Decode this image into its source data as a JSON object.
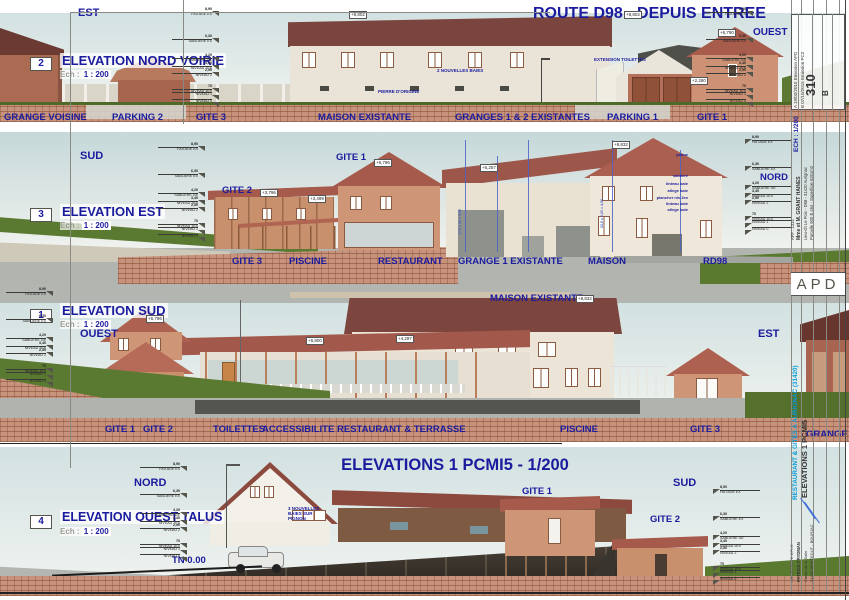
{
  "colors": {
    "label_navy": "#1b1b9e",
    "project_cyan": "#0a9bd8",
    "roof_red": "#8c4a3e",
    "timber": "#cf9577",
    "grass_green": "#5b7a31",
    "earth_brick": "#c8937c"
  },
  "sheet": {
    "route_title": "ROUTE D98 - DEPUIS ENTREE",
    "main_title": "ELEVATIONS 1 PCMI5  -  1/200"
  },
  "levels": {
    "items": [
      {
        "value": "8,90",
        "label": "FAITAGE EX",
        "gap": 0
      },
      {
        "value": "6,30",
        "label": "SABLIERE EX",
        "gap": 20
      },
      {
        "value": "4,20",
        "label": "SABLIERE GE",
        "gap": 12
      },
      {
        "value": "3,40",
        "label": "NIVEAU 2EX",
        "gap": 1
      },
      {
        "value": "2,50",
        "label": "NIVEAU 2",
        "gap": 0
      },
      {
        "value": "70",
        "label": "NIVEAU 1EX",
        "gap": 9
      },
      {
        "value": "",
        "label": "NIVEAU 1",
        "gap": 0
      },
      {
        "value": "",
        "label": "NIVEAU 0",
        "gap": 0
      }
    ]
  },
  "band1": {
    "number": "2",
    "title": "ELEVATION NORD VOIRIE",
    "ech": "Ech :",
    "scale": "1 : 200",
    "dir_left": "EST",
    "dir_right": "OUEST",
    "ann_baies": "2 NOUVELLES BAIES",
    "ann_pierre": "PIERRE D'ORIGINE",
    "ann_toilettes": "EXTENSION TOILETTES",
    "spot1": "+8,802",
    "spot2": "+8,802",
    "spot3": "+6,790",
    "spot4": "+2,280",
    "lbl_grange": "GRANGE VOISINE",
    "lbl_parking2": "PARKING 2",
    "lbl_gite3": "GITE 3",
    "lbl_maison": "MAISON EXISTANTE",
    "lbl_granges": "GRANGES 1 & 2 EXISTANTES",
    "lbl_parking1": "PARKING 1",
    "lbl_gite1": "GITE 1"
  },
  "band2": {
    "number": "3",
    "title": "ELEVATION EST",
    "ech": "Ech :",
    "scale": "1 : 200",
    "dir_left": "SUD",
    "dir_right": "NORD",
    "top_gite1": "GITE 1",
    "top_gite2": "GITE 2",
    "spot_gite1": "+6,796",
    "spot_gite2": "+3,796",
    "spot_rest": "+3,499",
    "spot_grange": "+6,257",
    "spot_maison": "+8,832",
    "dim_note1": "17,5 x 20 = 3,50",
    "dim_note2": "23,5 x 0,20 = 4,50",
    "annotations": [
      {
        "t": "panne",
        "gap": 0
      },
      {
        "t": "sabliere",
        "gap": 16
      },
      {
        "t": "linteau baie",
        "gap": 3
      },
      {
        "t": "allege baie",
        "gap": 2
      },
      {
        "t": "plancher niv 2ex",
        "gap": 2
      },
      {
        "t": "linteau baie",
        "gap": 1
      },
      {
        "t": "allege baie",
        "gap": 1
      }
    ],
    "lbl_gite3": "GITE 3",
    "lbl_piscine": "PISCINE",
    "lbl_restaurant": "RESTAURANT",
    "lbl_grange1": "GRANGE 1 EXISTANTE",
    "lbl_maison": "MAISON",
    "lbl_rd98": "RD98"
  },
  "band3": {
    "number": "1",
    "title": "ELEVATION SUD",
    "ech": "Ech :",
    "scale": "1 : 200",
    "dir_left": "OUEST",
    "dir_right": "EST",
    "top_maison": "MAISON EXISTANTE",
    "spot_gite": "+6,796",
    "spot_terrasse": "+6,800",
    "spot_maison": "+8,832",
    "spot_roof": "+4,297",
    "lbl_gite1": "GITE 1",
    "lbl_gite2": "GITE 2",
    "lbl_toilettes": "TOILETTES",
    "lbl_access": "ACCESSIBILITE",
    "lbl_rest": "RESTAURANT & TERRASSE",
    "lbl_piscine": "PISCINE",
    "lbl_gite3": "GITE 3",
    "lbl_grange": "GRANGE VOISINE"
  },
  "band4": {
    "number": "4",
    "title": "ELEVATION OUEST TALUS",
    "ech": "Ech :",
    "scale": "1 : 200",
    "dir_left": "NORD",
    "dir_right": "SUD",
    "tn": "TN 0.00",
    "lbl_gite1": "GITE 1",
    "lbl_gite2": "GITE 2",
    "ann_baies": "3 NOUVELLES BAIES SUR PIGNON"
  },
  "titleblock": {
    "rev_a": "A  19/02/2015  Emission APD",
    "rev_b": "B  07/10/2015  Emission PC2",
    "sheet_number": "310",
    "rev_letter": "B",
    "ech": "ECH : 1/200",
    "aff": "AFF : 1314",
    "client": "Mme et M. GRANT HAINES",
    "lieu": "Lieu-dit Le Poix - D98 - 31420 Aurignac",
    "parcelle": "Parcelle 900 E 464 - Superficie 6261m2",
    "phase": "APD",
    "project": "RESTAURANT & GITES A AURIGNAC (31420)",
    "sheet_name": "ELEVATIONS 1 PCMI5",
    "arch_title": "ARCHITECTE DPLG",
    "arch_name": "PATRICK FRYDMAN",
    "arch_addr1": "Camin de la Salle",
    "arch_addr2": "31430 MONTEGUT - BOURJAC"
  }
}
